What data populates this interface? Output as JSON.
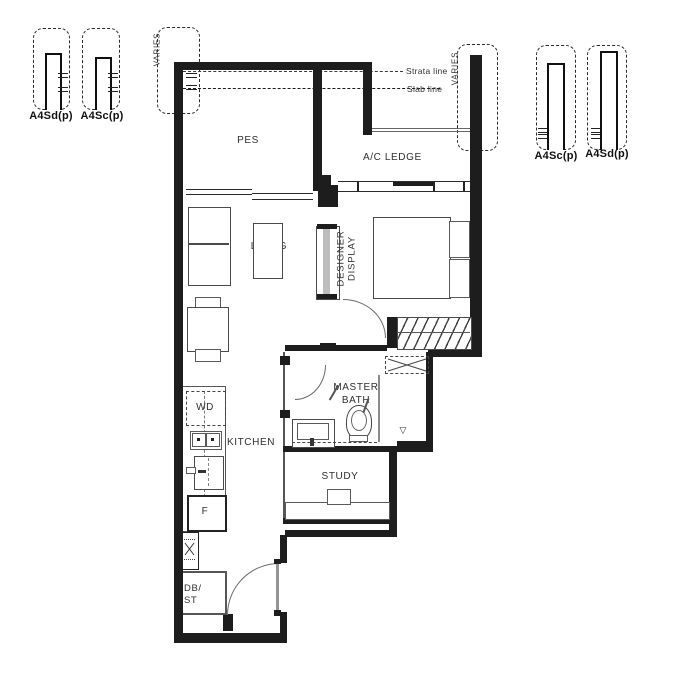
{
  "legend": {
    "top_left": [
      {
        "label": "A4Sd(p)"
      },
      {
        "label": "A4Sc(p)"
      }
    ],
    "top_right": [
      {
        "label": "A4Sc(p)"
      },
      {
        "label": "A4Sd(p)"
      }
    ]
  },
  "annotations": {
    "varies_left": "VARIES",
    "varies_right": "VARIES",
    "strata_line": "Strata line",
    "slab_line": "Slab line"
  },
  "rooms": {
    "pes": "PES",
    "ac_ledge": "A/C LEDGE",
    "living": "LIVING",
    "master_bedroom": "MASTER BEDROOM",
    "dining": "DINING",
    "kitchen": "KITCHEN",
    "master_bath": "MASTER BATH",
    "study": "STUDY"
  },
  "fixtures": {
    "washer_dryer": "WD",
    "fridge": "F",
    "db_line1": "DB/",
    "db_line2": "ST",
    "designer_display_line1": "DESIGNER",
    "designer_display_line2": "DISPLAY"
  },
  "colors": {
    "wall": "#1d1d1d",
    "furniture_line": "#4a4a4a",
    "background": "#ffffff"
  }
}
